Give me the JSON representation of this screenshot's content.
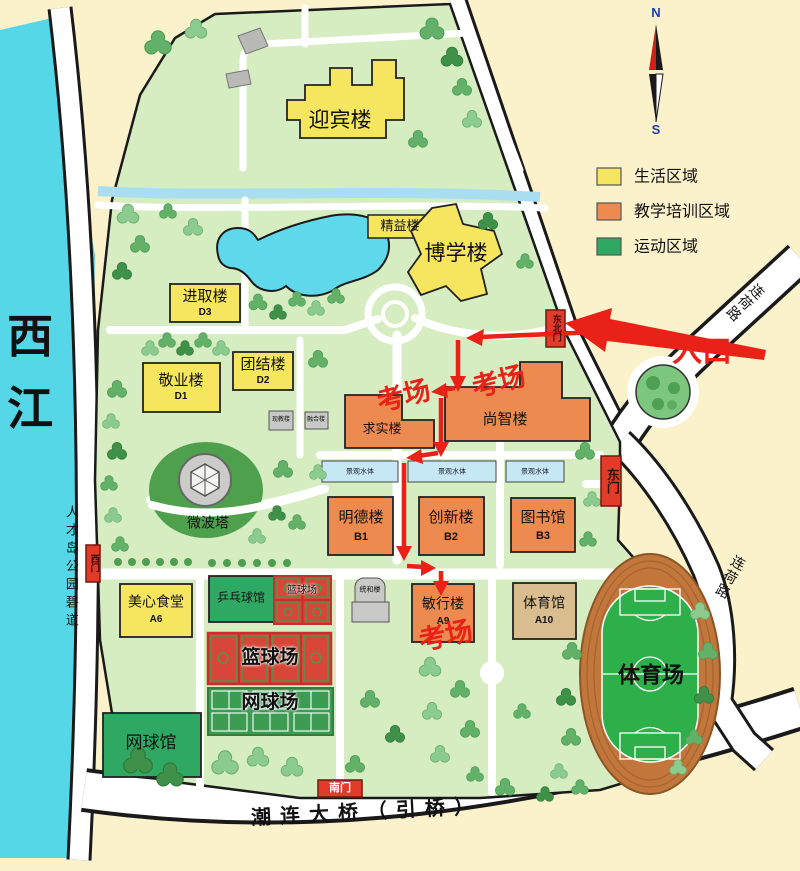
{
  "legend": {
    "items": [
      {
        "label": "生活区域",
        "color": "#F6E55F"
      },
      {
        "label": "教学培训区域",
        "color": "#ED8A4F"
      },
      {
        "label": "运动区域",
        "color": "#2FA863"
      }
    ]
  },
  "compass": {
    "north": "N",
    "south": "S"
  },
  "river": {
    "label": "西江"
  },
  "roads": {
    "west_greenway": "人才岛公园碧道",
    "lianhe_north": "连荷路",
    "lianhe_east": "连荷路",
    "south_bridge": "潮连大桥（引桥）"
  },
  "gates": {
    "northeast": "东北门",
    "east": "东门",
    "west": "西门",
    "south": "南门"
  },
  "annotations": {
    "entrance": "入口",
    "exam_right": "考场",
    "exam_left": "考场",
    "exam_bottom": "考场"
  },
  "water_features": {
    "strip_labels": [
      "景观水体",
      "景观水体",
      "景观水体"
    ]
  },
  "buildings": {
    "yingbin": {
      "name": "迎宾楼"
    },
    "jingyi": {
      "name": "精益楼"
    },
    "boxue": {
      "name": "博学楼"
    },
    "jinqu": {
      "name": "进取楼",
      "code": "D3"
    },
    "tuanjie": {
      "name": "团结楼",
      "code": "D2"
    },
    "jingye": {
      "name": "敬业楼",
      "code": "D1"
    },
    "xianjiao": {
      "name": "现教楼"
    },
    "ronghe": {
      "name": "融合楼"
    },
    "qiushi": {
      "name": "求实楼"
    },
    "shangzhi": {
      "name": "尚智楼"
    },
    "mingde": {
      "name": "明德楼",
      "code": "B1"
    },
    "chuangxin": {
      "name": "创新楼",
      "code": "B2"
    },
    "tushuguan": {
      "name": "图书馆",
      "code": "B3"
    },
    "meixin": {
      "name": "美心食堂",
      "code": "A6"
    },
    "pingpang": {
      "name": "乒乓球馆"
    },
    "lanqiu_small": {
      "name": "篮球场"
    },
    "tonghe": {
      "name": "统和楼"
    },
    "minxing": {
      "name": "敏行楼",
      "code": "A9"
    },
    "tiyuguan": {
      "name": "体育馆",
      "code": "A10"
    },
    "lanqiu_big": {
      "name": "篮球场"
    },
    "wangqiu_chang": {
      "name": "网球场"
    },
    "wangqiu_guan": {
      "name": "网球馆"
    },
    "weibota": {
      "name": "微波塔"
    },
    "tiyuchang": {
      "name": "体育场"
    }
  }
}
